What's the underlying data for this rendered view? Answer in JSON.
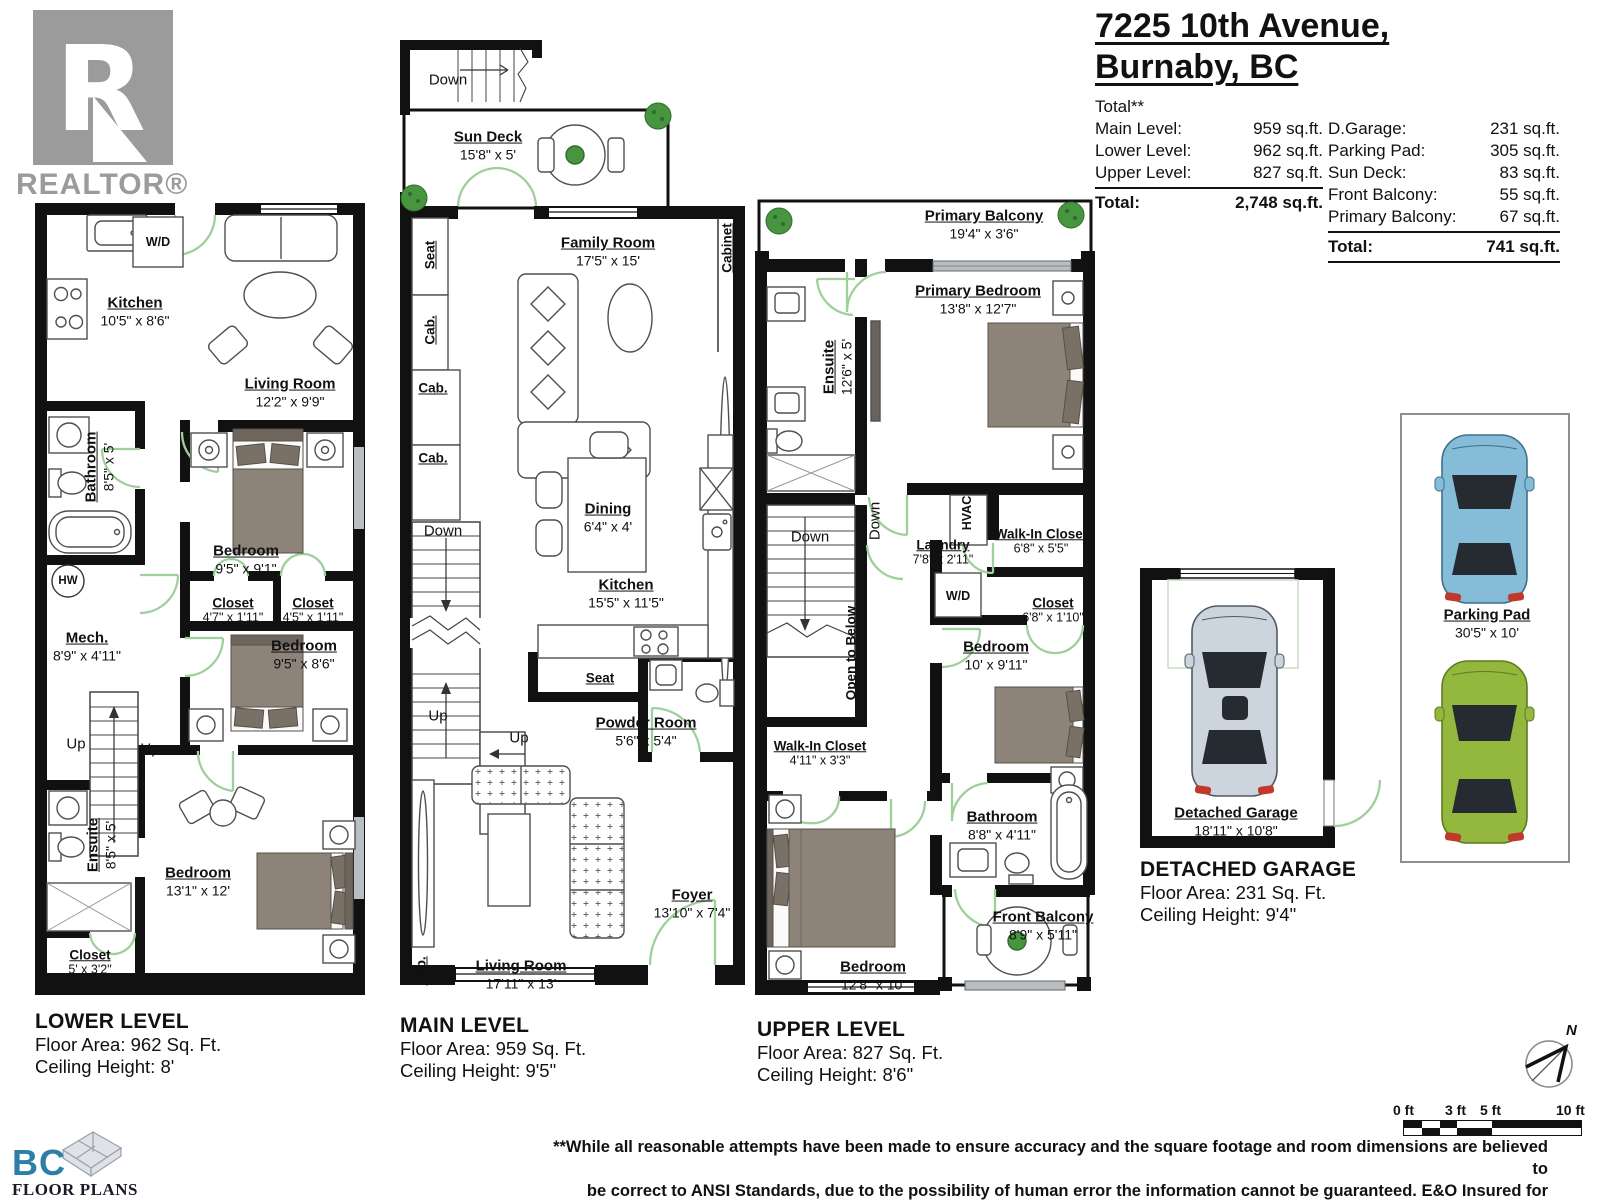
{
  "realtor_logo": {
    "r": "R",
    "wordmark": "REALTOR®"
  },
  "title": {
    "line1": "7225 10th Avenue,",
    "line2": "Burnaby, BC"
  },
  "summary": {
    "heading": "Total**",
    "left_rows": [
      {
        "label": "Main Level:",
        "value": "959 sq.ft."
      },
      {
        "label": "Lower Level:",
        "value": "962 sq.ft."
      },
      {
        "label": "Upper Level:",
        "value": "827 sq.ft."
      }
    ],
    "left_total_label": "Total:",
    "left_total_value": "2,748 sq.ft.",
    "right_rows": [
      {
        "label": "D.Garage:",
        "value": "231 sq.ft."
      },
      {
        "label": "Parking Pad:",
        "value": "305 sq.ft."
      },
      {
        "label": "Sun Deck:",
        "value": "83 sq.ft."
      },
      {
        "label": "Front Balcony:",
        "value": "55 sq.ft."
      },
      {
        "label": "Primary Balcony:",
        "value": "67 sq.ft."
      }
    ],
    "right_total_label": "Total:",
    "right_total_value": "741 sq.ft."
  },
  "lower": {
    "rooms": {
      "kitchen": {
        "name": "Kitchen",
        "dims": "10'5\" x 8'6\""
      },
      "living": {
        "name": "Living Room",
        "dims": "12'2\" x 9'9\""
      },
      "bathroom": {
        "name": "Bathroom",
        "dims": "8'5\" x 5'"
      },
      "bedroom1": {
        "name": "Bedroom",
        "dims": "9'5\" x 9'1\""
      },
      "mech": {
        "name": "Mech.",
        "dims": "8'9\" x 4'11\""
      },
      "closet1": {
        "name": "Closet",
        "dims": "4'7\" x 1'11\""
      },
      "closet2": {
        "name": "Closet",
        "dims": "4'5\" x 1'11\""
      },
      "bedroom2": {
        "name": "Bedroom",
        "dims": "9'5\" x 8'6\""
      },
      "ensuite": {
        "name": "Ensuite",
        "dims": "8'5\" x 5'"
      },
      "bedroom3": {
        "name": "Bedroom",
        "dims": "13'1\" x 12'"
      },
      "closet3": {
        "name": "Closet",
        "dims": "5' x 3'2\""
      }
    },
    "labels": {
      "wd": "W/D",
      "hw": "HW",
      "up": "Up"
    },
    "caption": {
      "name": "LOWER LEVEL",
      "area": "Floor Area: 962 Sq. Ft.",
      "ceiling": "Ceiling Height: 8'"
    }
  },
  "main": {
    "rooms": {
      "sundeck": {
        "name": "Sun Deck",
        "dims": "15'8\" x 5'"
      },
      "family": {
        "name": "Family Room",
        "dims": "17'5\" x 15'"
      },
      "dining": {
        "name": "Dining",
        "dims": "6'4\" x 4'"
      },
      "kitchen": {
        "name": "Kitchen",
        "dims": "15'5\" x 11'5\""
      },
      "powder": {
        "name": "Powder Room",
        "dims": "5'6\" x 5'4\""
      },
      "living": {
        "name": "Living Room",
        "dims": "17'11\" x 13'"
      },
      "foyer": {
        "name": "Foyer",
        "dims": "13'10\" x 7'4\""
      }
    },
    "labels": {
      "down": "Down",
      "up": "Up",
      "seat": "Seat",
      "cab": "Cab.",
      "cabinet": "Cabinet"
    },
    "caption": {
      "name": "MAIN LEVEL",
      "area": "Floor Area: 959 Sq. Ft.",
      "ceiling": "Ceiling Height: 9'5\""
    }
  },
  "upper": {
    "rooms": {
      "balcony": {
        "name": "Primary Balcony",
        "dims": "19'4\" x 3'6\""
      },
      "primary": {
        "name": "Primary Bedroom",
        "dims": "13'8\" x 12'7\""
      },
      "ensuite": {
        "name": "Ensuite",
        "dims": "12'6\" x 5'"
      },
      "laundry": {
        "name": "Laundry",
        "dims": "7'8\" x 2'11\""
      },
      "wic1": {
        "name": "Walk-In Closet",
        "dims": "6'8\" x 5'5\""
      },
      "closet": {
        "name": "Closet",
        "dims": "6'8\" x 1'10\""
      },
      "bedroom1": {
        "name": "Bedroom",
        "dims": "10' x 9'11\""
      },
      "wic2": {
        "name": "Walk-In Closet",
        "dims": "4'11\" x 3'3\""
      },
      "bathroom": {
        "name": "Bathroom",
        "dims": "8'8\" x 4'11\""
      },
      "bedroom2": {
        "name": "Bedroom",
        "dims": "12'8\" x 10'"
      },
      "front_balcony": {
        "name": "Front Balcony",
        "dims": "8'9\" x 5'11\""
      }
    },
    "labels": {
      "down": "Down",
      "open_below": "Open to Below",
      "hvac": "HVAC",
      "wd": "W/D"
    },
    "caption": {
      "name": "UPPER LEVEL",
      "area": "Floor Area: 827 Sq. Ft.",
      "ceiling": "Ceiling Height: 8'6\""
    }
  },
  "garage": {
    "room": {
      "name": "Detached Garage",
      "dims": "18'11\" x 10'8\""
    },
    "caption": {
      "name": "DETACHED GARAGE",
      "area": "Floor Area: 231 Sq. Ft.",
      "ceiling": "Ceiling Height: 9'4\""
    }
  },
  "parking": {
    "name": "Parking Pad",
    "dims": "30'5\" x 10'"
  },
  "compass": {
    "north": "N"
  },
  "scale_bar": {
    "labels": [
      "0 ft",
      "3 ft",
      "5 ft",
      "10 ft"
    ]
  },
  "footer": {
    "line1": "**While all reasonable attempts have been made to ensure accuracy and the square footage and room dimensions are believed to",
    "line2": "be correct to ANSI Standards, due to the possibility of human error the information cannot be guaranteed. E&O Insured for $1,000,000",
    "line3": "** May Include Unfinished areas"
  },
  "bc_logo": {
    "bc": "BC",
    "name": "FLOOR PLANS"
  },
  "colors": {
    "wall": "#111111",
    "door": "#9fcf9b",
    "bed": "#8d8378",
    "car_blue": "#85bdd8",
    "car_green": "#93b83d",
    "car_gray": "#ccd5dd"
  }
}
